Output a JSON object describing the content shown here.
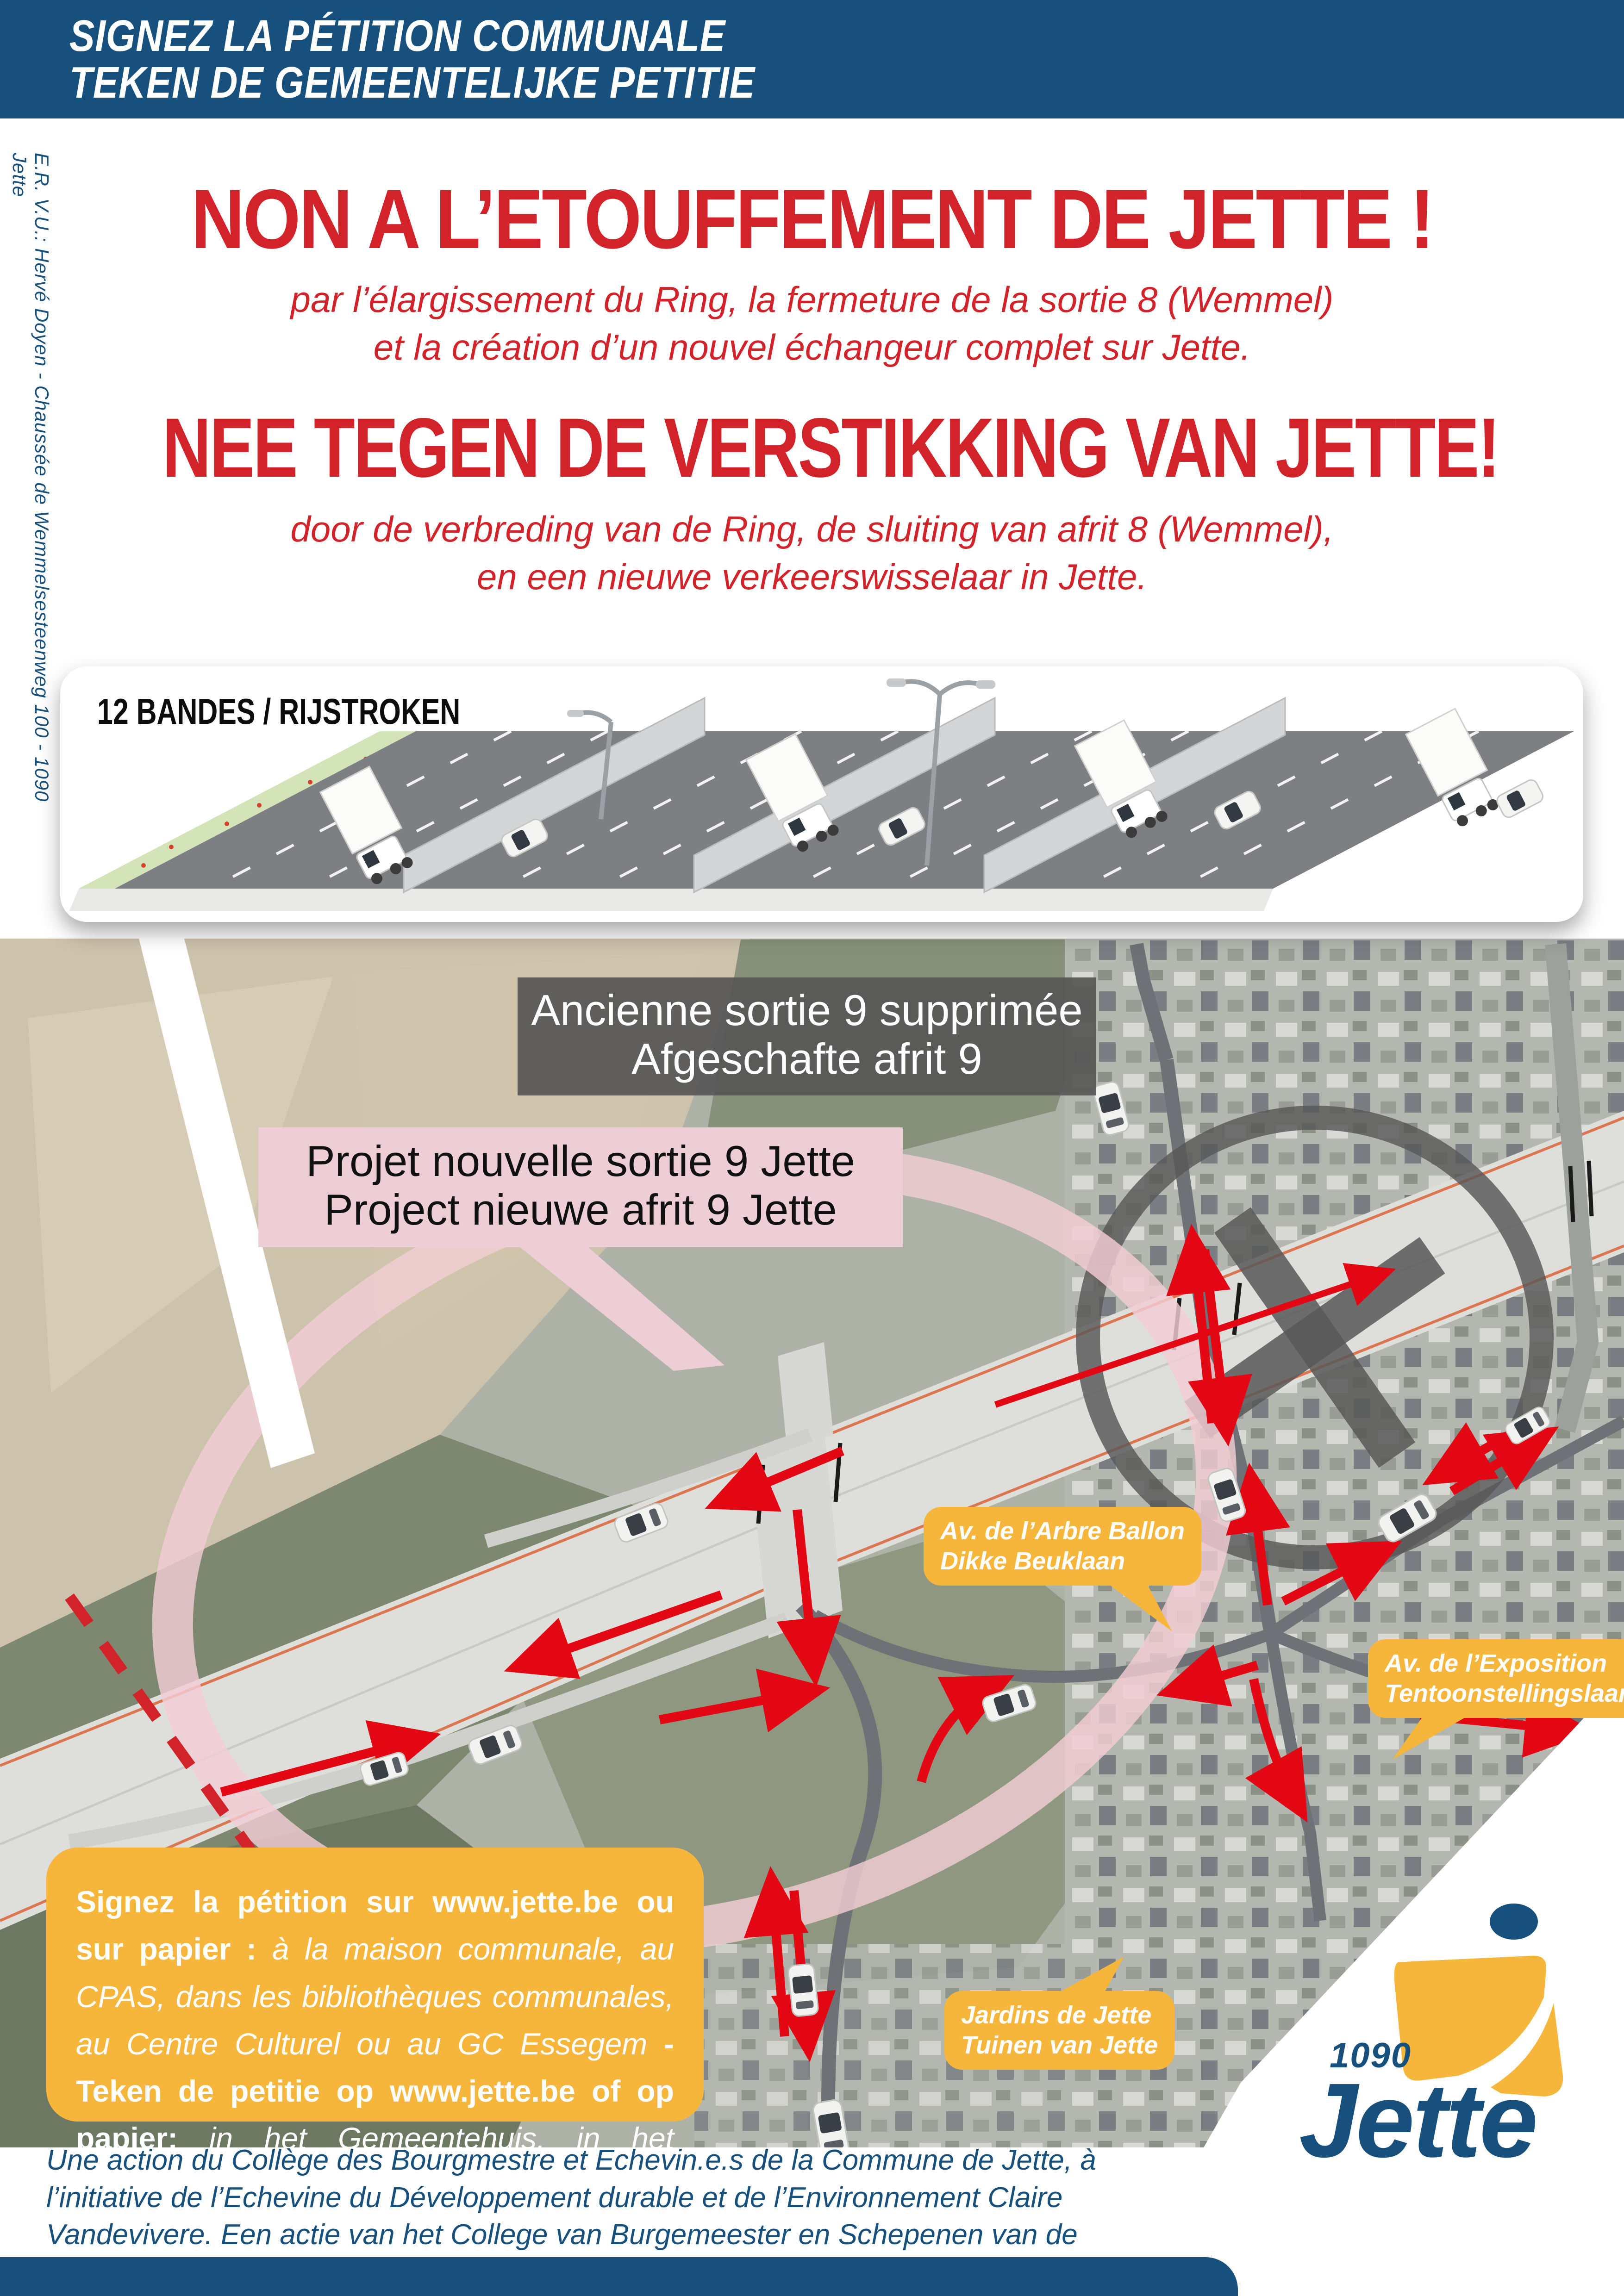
{
  "colors": {
    "brand_blue": "#17507c",
    "accent_red": "#d2232a",
    "arrow_red": "#e30613",
    "bubble_yellow": "#f6b63b",
    "pink_label": "#eeced6",
    "gray_label": "#565656"
  },
  "banner": {
    "lines": "SIGNEZ LA PÉTITION COMMUNALE\nTEKEN DE GEMEENTELIJKE PETITIE"
  },
  "sidebar": {
    "credit": "E.R. V.U.: Hervé Doyen - Chaussée de Wemmelsesteenweg 100 - 1090 Jette"
  },
  "headline_fr": {
    "title": "NON A L’ETOUFFEMENT DE JETTE !",
    "subtitle": "par l’élargissement du Ring, la fermeture de la sortie 8 (Wemmel)\net la création d’un nouvel échangeur complet sur Jette."
  },
  "headline_nl": {
    "title": "NEE TEGEN DE VERSTIKKING VAN JETTE!",
    "subtitle": "door de verbreding van de Ring, de sluiting van afrit 8 (Wemmel),\nen een nieuwe verkeerswisselaar in Jette."
  },
  "lanes_box": {
    "title": "12 BANDES / RIJSTROKEN"
  },
  "map_labels": {
    "old_exit": "Ancienne sortie 9 supprimée\nAfgeschafte afrit 9",
    "new_exit": "Projet nouvelle sortie 9 Jette\nProject nieuwe afrit 9 Jette",
    "arbre_ballon": "Av. de l’Arbre Ballon\nDikke Beuklaan",
    "exposition": "Av. de l’Exposition\nTentoonstellingslaan",
    "jardins": "Jardins de Jette\nTuinen van Jette"
  },
  "petition_box": {
    "segments": [
      {
        "text": "Signez la pétition sur www.jette.be ou sur papier : ",
        "style": "seg-b"
      },
      {
        "text": "à la maison communale, au CPAS, dans les bibliothèques communales, au Centre Culturel ou au GC Essegem ",
        "style": "seg-i"
      },
      {
        "text": "- Teken de petitie op www.jette.be of op papier: ",
        "style": "seg-b"
      },
      {
        "text": "in het Gemeentehuis, in het OCMW, in de BIB, in GC Essegem of het Centre Culturel.",
        "style": "seg-i"
      }
    ]
  },
  "disclaimer": {
    "text": "Une action du Collège des Bourgmestre et Echevin.e.s de la Commune de Jette, à l’initiative de l’Echevine du Développement durable et de l’Environnement Claire Vandevivere. Een actie van het College van Burgemeester en Schepenen van de Gemeente Jette, op initiatief van Schepen van Duurzame Ontwikkeling en Leefmilieu Claire Vandevivere."
  },
  "logo": {
    "postcode": "1090",
    "name": "Jette"
  }
}
